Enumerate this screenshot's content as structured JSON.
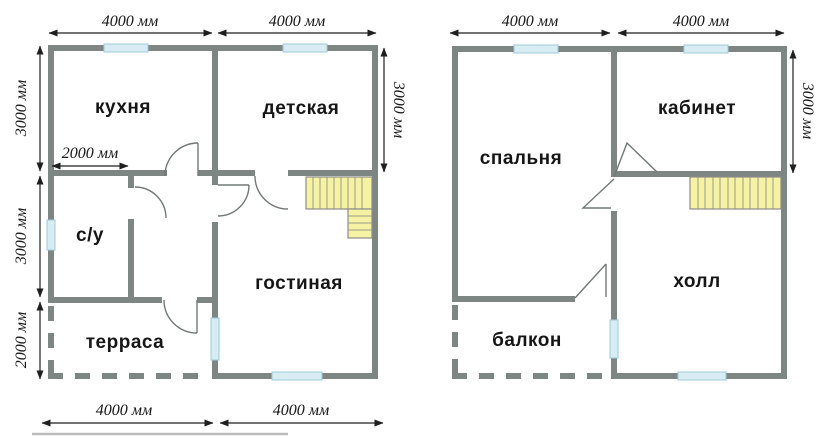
{
  "colors": {
    "wall": "#7e8684",
    "window_fill": "#d7edf3",
    "window_hatch": "#a5cdd9",
    "stairs_fill": "#f6f2a3",
    "door_line": "#717977",
    "dimension_text": "#151515",
    "room_text": "#161616",
    "background": "#ffffff"
  },
  "floor1": {
    "rooms": {
      "kitchen": "кухня",
      "nursery": "детская",
      "bathroom": "с/у",
      "living_room": "гостиная",
      "terrace": "терраса"
    },
    "dims": {
      "top": [
        "4000 мм",
        "4000 мм"
      ],
      "bottom": [
        "4000 мм",
        "4000 мм"
      ],
      "left": [
        "3000 мм",
        "3000 мм",
        "2000 мм"
      ],
      "right": "3000 мм",
      "inner": "2000 мм"
    }
  },
  "floor2": {
    "rooms": {
      "bedroom": "спальня",
      "study": "кабинет",
      "hall": "холл",
      "balcony": "балкон"
    },
    "dims": {
      "top": [
        "4000 мм",
        "4000 мм"
      ],
      "right": "3000 мм"
    }
  }
}
